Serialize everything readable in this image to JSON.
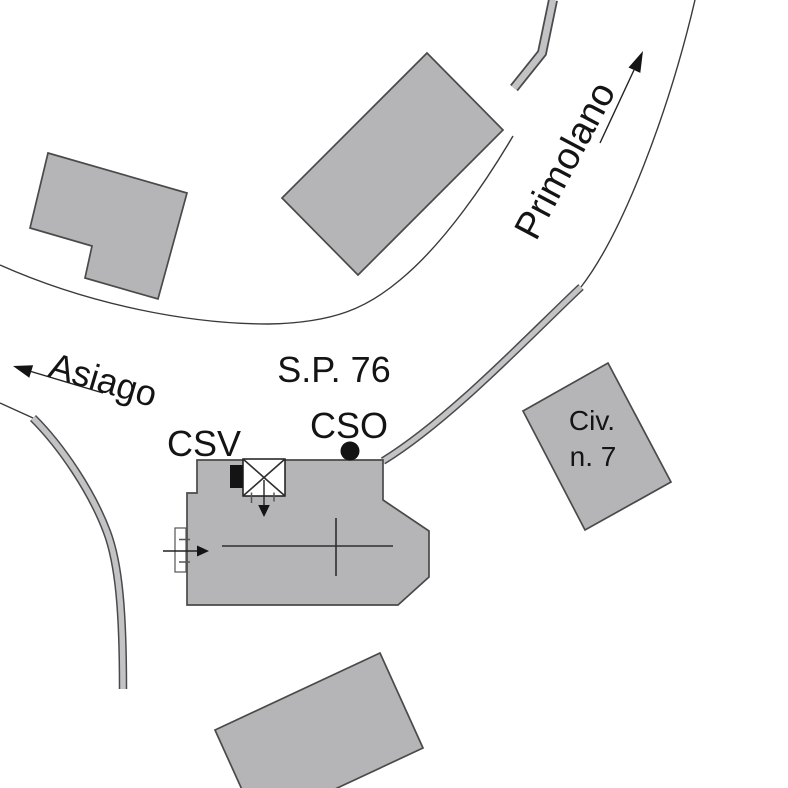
{
  "page": {
    "title": "Planimetric site map"
  },
  "labels": {
    "road": "S.P. 76",
    "dest_left": "Asiago",
    "dest_upper_right": "Primolano",
    "csv": "CSV",
    "cso": "CSO",
    "civ_line1": "Civ.",
    "civ_line2": "n. 7"
  },
  "markers": {
    "cso_symbol": "filled-circle",
    "csv_symbol": "crossed-box-with-black-rect",
    "direction_symbol": "solid-triangle-arrow"
  },
  "colors": {
    "background": "#ffffff",
    "building-fill": "#b5b5b7",
    "band-fill": "#c3c3c5",
    "outline": "#4a4a4a",
    "road-line": "#3a3a3a",
    "ink": "#141414"
  }
}
